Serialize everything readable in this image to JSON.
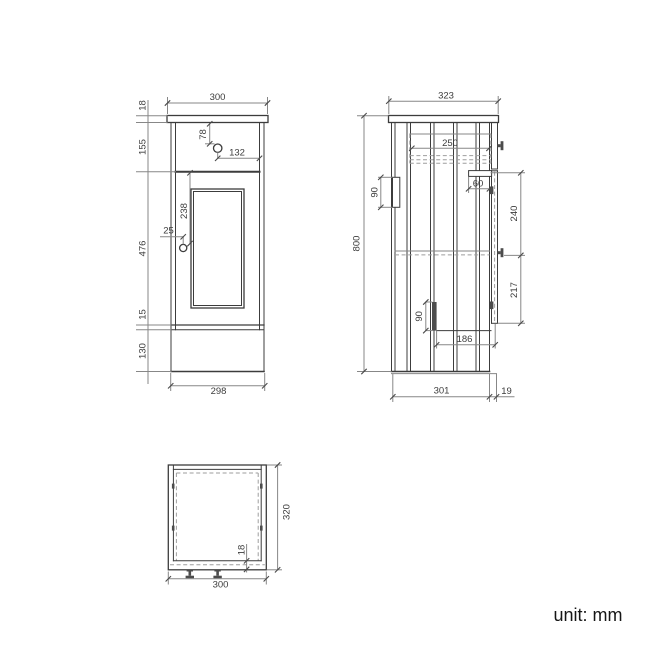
{
  "note": "unit: mm",
  "front_view": {
    "dims": {
      "width_top": "300",
      "counter_thickness": "18",
      "drawer_height": "155",
      "drawer_knob_from_top": "78",
      "drawer_knob_from_right": "132",
      "door_height": "476",
      "door_knob_from_top": "238",
      "door_knob_from_edge": "25",
      "bottom_rail": "15",
      "plinth_height": "130",
      "width_bottom": "298"
    }
  },
  "side_view": {
    "dims": {
      "depth_top": "323",
      "height": "800",
      "drawer_depth": "250",
      "back_rail_height": "90",
      "bracket_width": "60",
      "door_knob_from_top": "240",
      "door_knob_to_bottom": "217",
      "runner_height": "90",
      "runner_to_front": "186",
      "depth_body": "301",
      "door_thickness": "19"
    }
  },
  "top_view": {
    "dims": {
      "width": "300",
      "depth": "320",
      "front_thickness": "18"
    }
  }
}
